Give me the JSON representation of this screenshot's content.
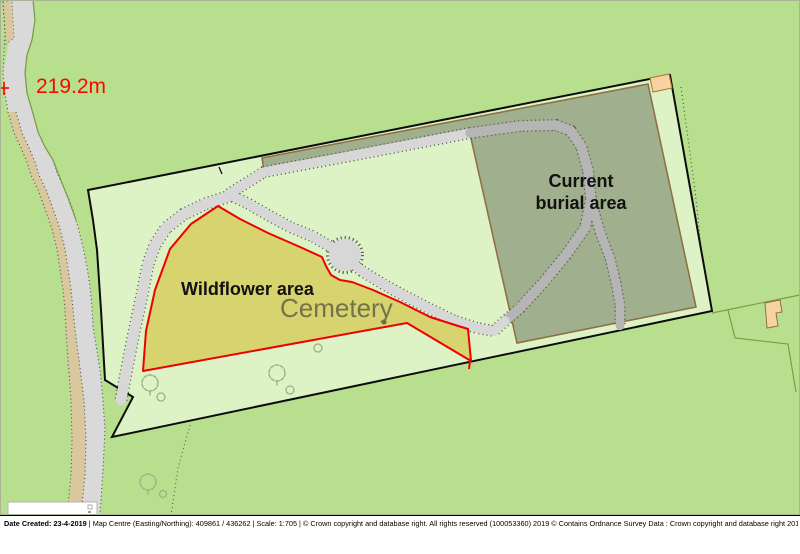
{
  "map": {
    "spot_height": "219.2m",
    "labels": {
      "wildflower": "Wildflower area",
      "cemetery": "Cemetery",
      "burial_line1": "Current",
      "burial_line2": "burial area"
    },
    "features": {
      "boundary": "cemetery-boundary",
      "wildflower_area": "wildflower-area-polygon",
      "burial_area": "current-burial-area-polygon",
      "road": "road-west",
      "paths": "cemetery-internal-paths",
      "symbols": [
        "tree-icon",
        "bush-icon",
        "building-icon",
        "spot-height-cross-icon"
      ]
    }
  },
  "colors": {
    "field_green": "#b7df8e",
    "cemetery_green": "#ddf3c6",
    "wildflower_yellow": "#d7d36e",
    "wildflower_outline": "#ee0000",
    "burial_fill": "#a0af8d",
    "burial_outline": "#8f7143",
    "road_gray": "#d9d9d9",
    "path_gray_light": "#d7d7d7",
    "path_gray_dark": "#b5b5b5",
    "verge_tan": "#d9c89e",
    "building_tan": "#f7d3a4",
    "spot_height_red": "#fb0700"
  },
  "footer": {
    "date": "Date Created: 23-4-2019 ",
    "details": "| Map Centre (Easting/Northing): 409861 / 436262 | Scale: 1:705 | © Crown copyright and database right. All rights reserved (100053360) 2019 © Contains Ordnance Survey Data : Crown copyright and database right 2019"
  }
}
